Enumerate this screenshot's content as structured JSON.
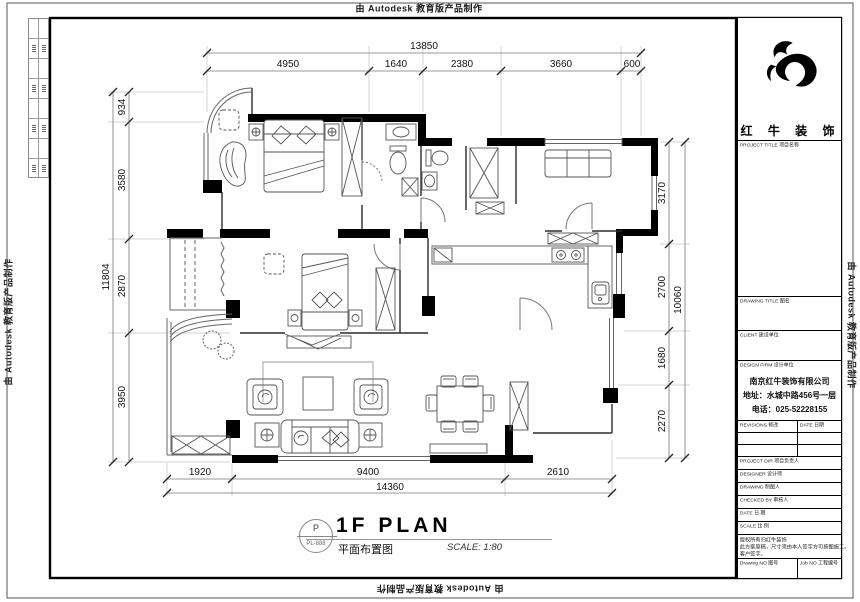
{
  "border": {
    "autodesk": "由 Autodesk 教育版产品制作"
  },
  "title_bar": {
    "bubble_top": "P",
    "bubble_bottom": "PL-888",
    "title": "1F PLAN",
    "subtitle_cn": "平面布置图",
    "scale": "SCALE: 1:80"
  },
  "dims": {
    "top": {
      "total": "13850",
      "segs": [
        "4950",
        "1640",
        "2380",
        "3660",
        "600"
      ]
    },
    "bottom": {
      "total": "14360",
      "segs": [
        "1920",
        "9400",
        "2610"
      ]
    },
    "left": {
      "total": "11804",
      "segs": [
        "934",
        "3580",
        "2870",
        "3950"
      ]
    },
    "right": {
      "total": "10060",
      "segs": [
        "3170",
        "2700",
        "1680",
        "2270"
      ]
    }
  },
  "title_block": {
    "brand": "红 牛 装 饰",
    "project_title": "PROJECT TITLE  项目名称",
    "drawing_title": "DRAWING TITLE  图名",
    "client": "CLIENT  建设单位",
    "design_firm": "DESIGN FIRM  设计单位",
    "company_name": "南京红牛装饰有限公司",
    "company_address": "地址：水城中路456号一层",
    "company_phone": "电话：025-52228155",
    "revisions": "REVISIONS  修改",
    "rev_date": "DATE  日期",
    "project_dir": "PROJECT DIR  项目负责人",
    "designer": "DESIGNER  设计师",
    "drawing_by": "DRAWING  制图人",
    "checked_by": "CHECKED BY  审核人",
    "date": "DATE  日 期",
    "scale": "SCALE  比 例",
    "note1": "版权所有归红牛装饰",
    "note2": "此方案原稿，尺寸须由本人签字方可按图施工。",
    "note3": "客户签字。",
    "drawing_no": "Drawing NO  图号",
    "job_no": "Job NO  工程编号"
  }
}
